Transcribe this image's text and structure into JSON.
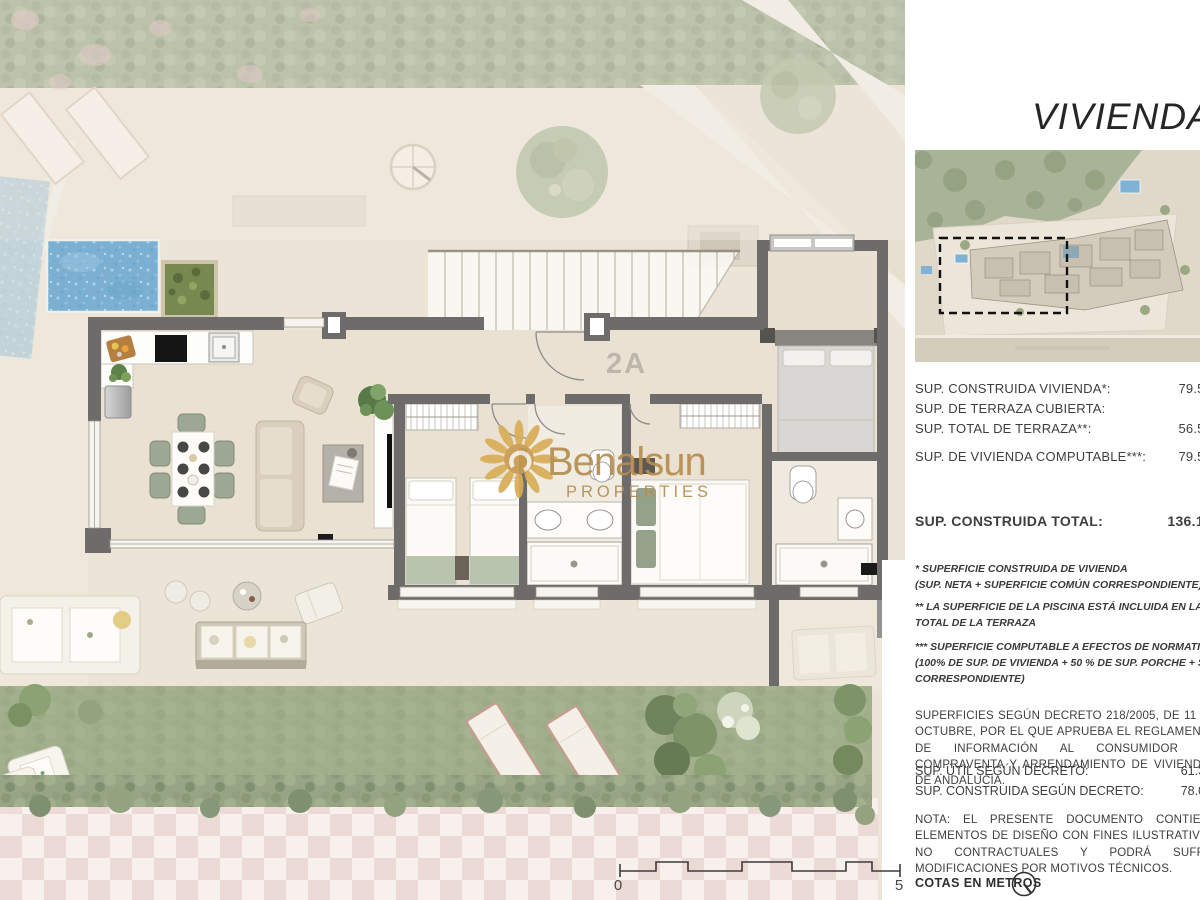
{
  "page": {
    "title": "VIVIENDA 2ºA"
  },
  "plan": {
    "unit_label": "2A",
    "watermark_brand": "Benalsun",
    "watermark_sub": "PROPERTIES",
    "scale_start": "0",
    "scale_end": "5"
  },
  "areas": {
    "rows": [
      {
        "label": "SUP. CONSTRUIDA VIVIENDA*:",
        "value": "79.59"
      },
      {
        "label": "SUP. DE TERRAZA CUBIERTA:",
        "value": "–"
      },
      {
        "label": "SUP. TOTAL DE TERRAZA**:",
        "value": "56.58"
      },
      {
        "label": "SUP. DE VIVIENDA COMPUTABLE***:",
        "value": "79.59"
      }
    ],
    "total_label": "SUP. CONSTRUIDA TOTAL:",
    "total_value": "136.17"
  },
  "footnotes": {
    "f1a": "* SUPERFICIE CONSTRUIDA DE VIVIENDA",
    "f1b": "(SUP. NETA + SUPERFICIE COMÚN CORRESPONDIENTE)",
    "f2a": "** LA SUPERFICIE DE LA PISCINA ESTÁ INCLUIDA EN LA SUPERFICIE",
    "f2b": "TOTAL DE LA TERRAZA",
    "f3a": "*** SUPERFICIE COMPUTABLE A EFECTOS DE NORMATIVA URBANÍSTICA",
    "f3b": "(100% DE SUP. DE VIVIENDA + 50 % DE SUP. PORCHE + SUP. COMÚN",
    "f3c": "CORRESPONDIENTE)"
  },
  "decree": {
    "paragraph": "SUPERFICIES SEGÚN DECRETO 218/2005, DE 11 DE OCTUBRE, POR EL QUE APRUEBA EL REGLAMENTO DE INFORMACIÓN AL CONSUMIDOR EN COMPRAVENTA Y ARRENDAMIENTO DE VIVIENDAS DE ANDALUCÍA.",
    "rows": [
      {
        "label": "SUP. ÚTIL SEGÚN DECRETO:",
        "value": "61.36"
      },
      {
        "label": "SUP. CONSTRUIDA SEGÚN DECRETO:",
        "value": "78.09"
      }
    ]
  },
  "note": "NOTA: EL PRESENTE DOCUMENTO CONTIENE ELEMENTOS DE DISEÑO CON FINES ILUSTRATIVOS NO CONTRACTUALES Y PODRÁ SUFRIR MODIFICACIONES POR MOTIVOS TÉCNICOS.",
  "cotas_label": "COTAS EN METROS",
  "colors": {
    "wall_gray": "#6d6c6a",
    "pool_blue": "#7cb0d3",
    "hedge_green": "#97a584",
    "checker_pink": "#ecd9d6",
    "watermark_gold": "#b58d50"
  }
}
